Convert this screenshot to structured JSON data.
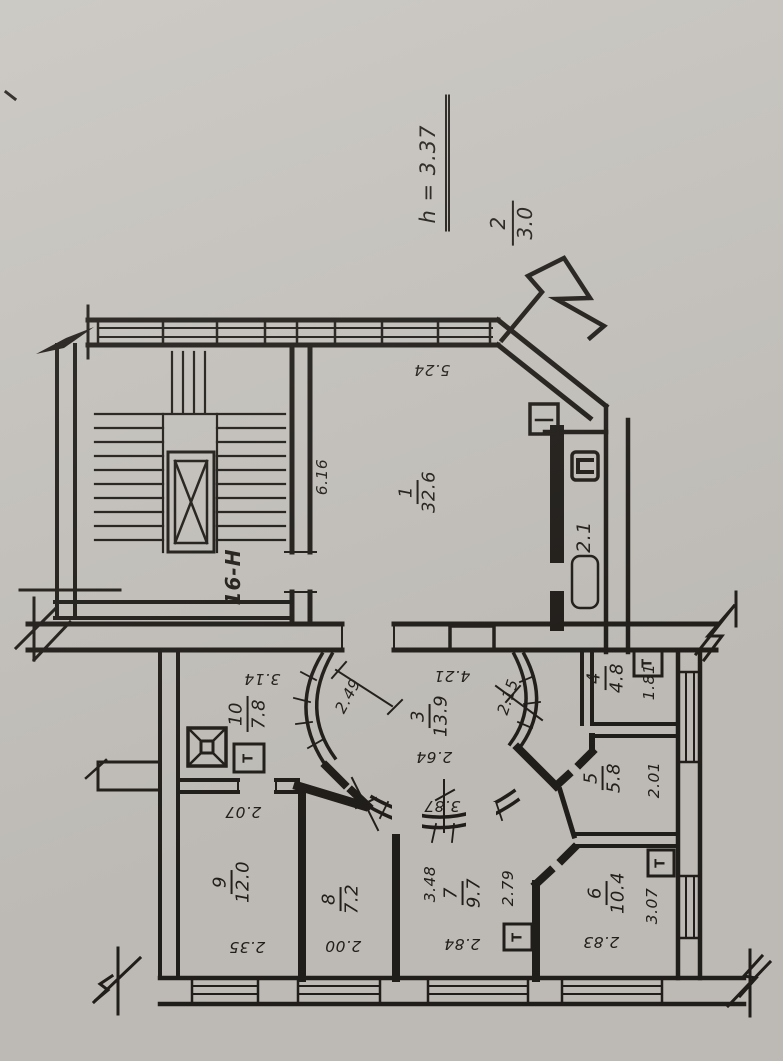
{
  "header": {
    "height_note": "h = 3.37",
    "floor_note": {
      "num": "2",
      "den": "3.0"
    }
  },
  "staircase": {
    "label": "16-Н"
  },
  "balcony": {
    "area": "2.1"
  },
  "rooms": {
    "r1": {
      "number": "1",
      "area": "32.6"
    },
    "r3": {
      "number": "3",
      "area": "13.9"
    },
    "r4": {
      "number": "4",
      "area": "4.8"
    },
    "r5": {
      "number": "5",
      "area": "5.8"
    },
    "r6": {
      "number": "6",
      "area": "10.4"
    },
    "r7": {
      "number": "7",
      "area": "9.7"
    },
    "r8": {
      "number": "8",
      "area": "7.2"
    },
    "r9": {
      "number": "9",
      "area": "12.0"
    },
    "r10": {
      "number": "10",
      "area": "7.8"
    }
  },
  "dims": {
    "room1_top": "5.24",
    "room1_left": "6.16",
    "hall_top": "4.21",
    "hall_left": "2.49",
    "hall_right": "2.15",
    "hall_mid": "2.64",
    "hall_bottom": "3.87",
    "room10_top": "3.14",
    "room9_top": "2.07",
    "room9_bottom": "2.35",
    "room8_bottom": "2.00",
    "room7_left": "3.48",
    "room7_right": "2.79",
    "room7_bottom": "2.84",
    "room6_right": "3.07",
    "room6_bottom": "2.83",
    "room5_right": "2.01",
    "room4_right": "1.81"
  },
  "symbols": {
    "radiator": "Т"
  },
  "colors": {
    "paper": "#c7c4bf",
    "ink": "#221f1b"
  }
}
